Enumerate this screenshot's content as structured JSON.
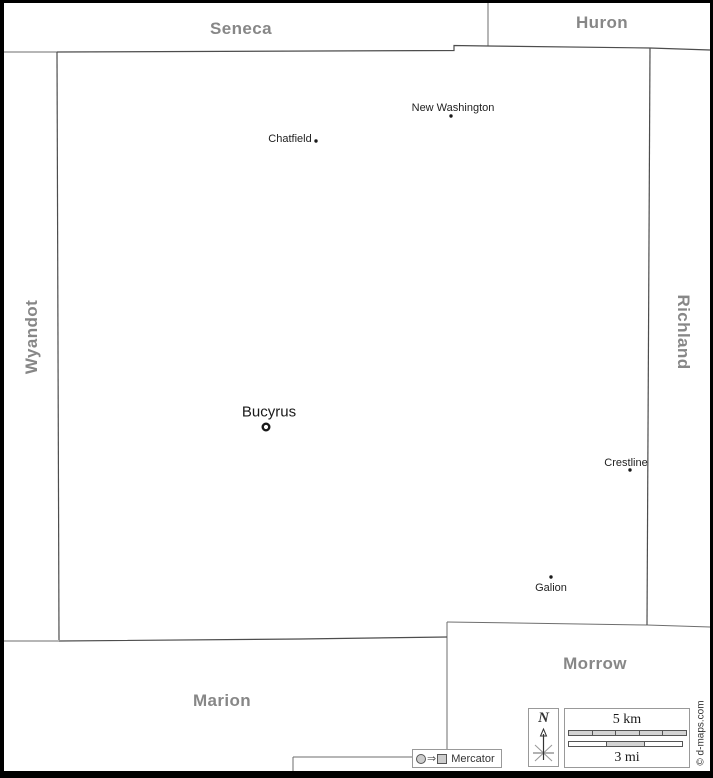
{
  "map": {
    "neighbors": {
      "seneca": "Seneca",
      "huron": "Huron",
      "wyandot": "Wyandot",
      "richland": "Richland",
      "marion": "Marion",
      "morrow": "Morrow"
    },
    "cities": [
      {
        "name": "New Washington",
        "marker": "dot"
      },
      {
        "name": "Chatfield",
        "marker": "dot"
      },
      {
        "name": "Bucyrus",
        "marker": "ring"
      },
      {
        "name": "Crestline",
        "marker": "dot"
      },
      {
        "name": "Galion",
        "marker": "dot"
      }
    ]
  },
  "legend": {
    "north": "N",
    "scale_km": "5 km",
    "scale_mi": "3 mi",
    "projection": "Mercator",
    "projection_arrow": "⇒"
  },
  "credit": "© d-maps.com",
  "colors": {
    "county_border": "#4d4d4d",
    "neighbor_line": "#6e6e6e",
    "county_label": "#878787",
    "city_label": "#222222"
  }
}
